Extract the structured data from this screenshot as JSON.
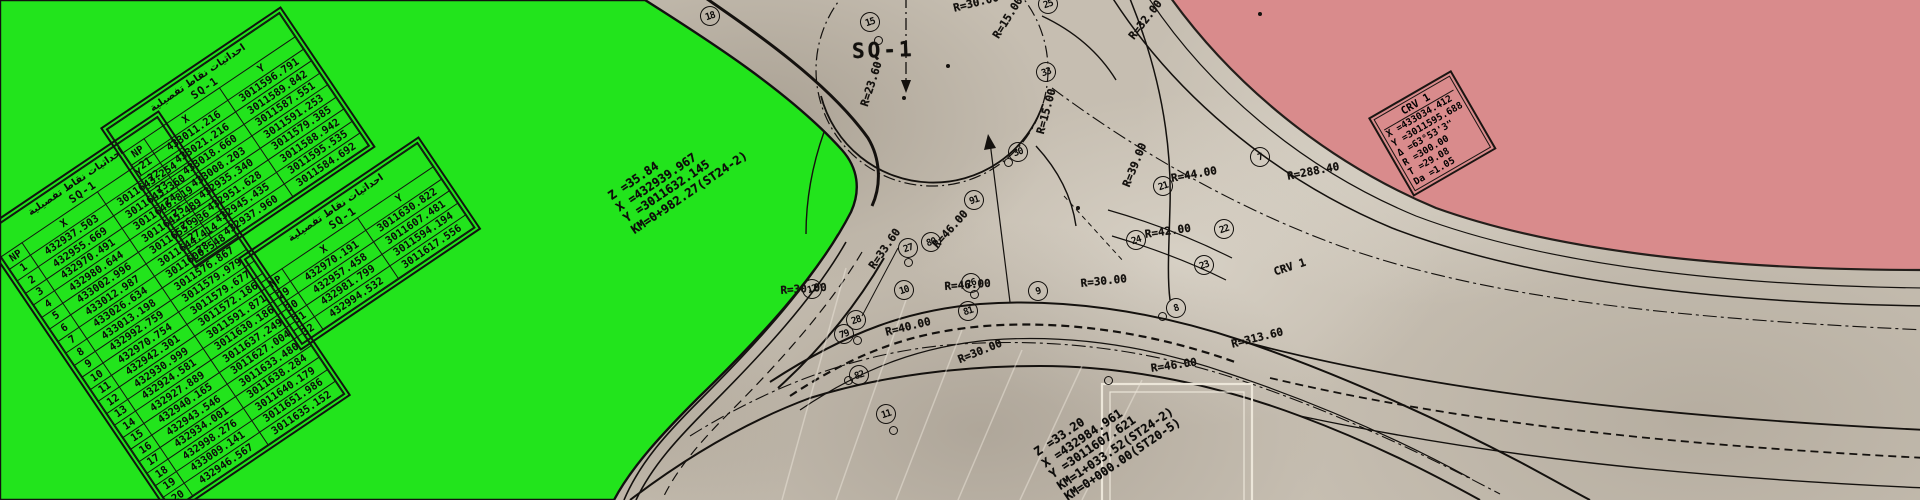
{
  "scene": {
    "square_label": "SQ-1",
    "colors": {
      "green_area": "#22e41c",
      "pink_area": "#d98b8c",
      "paper": "#c6beb1",
      "ink": "#14110e",
      "faint_line": "#f2ece0"
    },
    "table_title_ar": "احداثيات نقاط تفصيلية"
  },
  "tables": [
    {
      "id": "sq1-a",
      "title_ar": "احداثيات نقاط تفصيلية",
      "title": "SQ-1",
      "headers": [
        "NP",
        "X",
        "Y"
      ],
      "pos": {
        "x": -22,
        "y": 232,
        "rot": -34
      },
      "rows": [
        [
          "1",
          "432937.503",
          "3011643.254"
        ],
        [
          "2",
          "432955.669",
          "3011643.360"
        ],
        [
          "3",
          "432970.491",
          "3011646.819"
        ],
        [
          "4",
          "432980.644",
          "3011645.489"
        ],
        [
          "5",
          "433002.996",
          "3011655.936"
        ],
        [
          "6",
          "433012.987",
          "3011644.414"
        ],
        [
          "7",
          "433026.634",
          "3011600.548"
        ],
        [
          "8",
          "433013.198",
          "3011576.867"
        ],
        [
          "9",
          "432992.759",
          "3011579.979"
        ],
        [
          "10",
          "432970.754",
          "3011579.677"
        ],
        [
          "11",
          "432942.301",
          "3011572.186"
        ],
        [
          "12",
          "432930.999",
          "3011591.871"
        ],
        [
          "13",
          "432924.581",
          "3011630.186"
        ],
        [
          "14",
          "432927.889",
          "3011637.249"
        ],
        [
          "15",
          "432940.165",
          "3011627.004"
        ],
        [
          "16",
          "432943.546",
          "3011633.480"
        ],
        [
          "17",
          "432934.001",
          "3011638.284"
        ],
        [
          "18",
          "432998.276",
          "3011640.179"
        ],
        [
          "19",
          "433009.141",
          "3011651.986"
        ],
        [
          "20",
          "432946.567",
          "3011635.152"
        ]
      ]
    },
    {
      "id": "sq1-b",
      "title_ar": "احداثيات نقاط تفصيلية",
      "title": "SQ-1",
      "headers": [
        "NP",
        "X",
        "Y"
      ],
      "pos": {
        "x": 100,
        "y": 128,
        "rot": -34
      },
      "rows": [
        [
          "21",
          "433011.216",
          "3011596.791"
        ],
        [
          "22",
          "433021.216",
          "3011589.842"
        ],
        [
          "23",
          "433018.660",
          "3011587.551"
        ],
        [
          "24",
          "433008.203",
          "3011591.253"
        ],
        [
          "25",
          "432935.340",
          "3011579.385"
        ],
        [
          "26",
          "432951.628",
          "3011588.942"
        ],
        [
          "27",
          "432945.435",
          "3011595.535"
        ],
        [
          "28",
          "432937.960",
          "3011584.692"
        ]
      ]
    },
    {
      "id": "sq1-c",
      "title_ar": "احداثيات نقاط تفصيلية",
      "title": "SQ-1",
      "headers": [
        "NP",
        "X",
        "Y"
      ],
      "pos": {
        "x": 238,
        "y": 258,
        "rot": -34
      },
      "rows": [
        [
          "29",
          "432970.191",
          "3011630.822"
        ],
        [
          "30",
          "432957.458",
          "3011607.481"
        ],
        [
          "31",
          "432981.799",
          "3011594.194"
        ],
        [
          "32",
          "432994.532",
          "3011617.556"
        ]
      ]
    }
  ],
  "annotation_blocks": [
    {
      "id": "sq1-center-data",
      "x": 606,
      "y": 192,
      "rot": -34,
      "lines": [
        "Z =35.84",
        "X =432939.967",
        "Y =3011632.145",
        "KM=0+982.27(ST24-2)"
      ]
    },
    {
      "id": "st20-junction-data",
      "x": 1032,
      "y": 448,
      "rot": -34,
      "lines": [
        "Z =33.20",
        "X =432984.961",
        "Y =3011607.621",
        "KM=1+033.52(ST24-2)",
        "KM=0+000.00(ST20-5)"
      ]
    }
  ],
  "crv_box": {
    "title": "CRV 1",
    "x": 1368,
    "y": 118,
    "rot": -30,
    "lines": [
      "X =433034.412",
      "Y =3011595.688",
      "Δ =63°53'3\"",
      "R =300.00",
      "T =29.08",
      "Da =1.05"
    ]
  },
  "radius_labels": [
    {
      "text": "R=30.00",
      "x": 952,
      "y": 2,
      "rot": -14
    },
    {
      "text": "R=15.00",
      "x": 990,
      "y": 34,
      "rot": -58
    },
    {
      "text": "R=15.00",
      "x": 1034,
      "y": 132,
      "rot": -75
    },
    {
      "text": "R=32.00",
      "x": 1126,
      "y": 34,
      "rot": -52
    },
    {
      "text": "R=23.60",
      "x": 858,
      "y": 104,
      "rot": -72
    },
    {
      "text": "R=33.60",
      "x": 866,
      "y": 264,
      "rot": -55
    },
    {
      "text": "R=46.00",
      "x": 930,
      "y": 242,
      "rot": -48
    },
    {
      "text": "R=40.00",
      "x": 884,
      "y": 326,
      "rot": -14
    },
    {
      "text": "R=30.00",
      "x": 780,
      "y": 284,
      "rot": -4
    },
    {
      "text": "R=46.00",
      "x": 944,
      "y": 280,
      "rot": -4
    },
    {
      "text": "R=30.00",
      "x": 1080,
      "y": 277,
      "rot": -6
    },
    {
      "text": "R=39.00",
      "x": 1120,
      "y": 184,
      "rot": -68
    },
    {
      "text": "R=44.00",
      "x": 1170,
      "y": 172,
      "rot": -10
    },
    {
      "text": "R=42.00",
      "x": 1144,
      "y": 228,
      "rot": -8
    },
    {
      "text": "R=288.40",
      "x": 1286,
      "y": 170,
      "rot": -11
    },
    {
      "text": "CRV 1",
      "x": 1272,
      "y": 266,
      "rot": -18
    },
    {
      "text": "R=313.60",
      "x": 1230,
      "y": 338,
      "rot": -14
    },
    {
      "text": "R=30.00",
      "x": 956,
      "y": 354,
      "rot": -22
    },
    {
      "text": "R=46.00",
      "x": 1150,
      "y": 362,
      "rot": -8
    }
  ],
  "survey_points": [
    {
      "n": "18",
      "x": 700,
      "y": 6
    },
    {
      "n": "15",
      "x": 860,
      "y": 12
    },
    {
      "n": "25",
      "x": 1038,
      "y": -6
    },
    {
      "n": "33",
      "x": 1036,
      "y": 62
    },
    {
      "n": "30",
      "x": 1008,
      "y": 142
    },
    {
      "n": "91",
      "x": 964,
      "y": 190
    },
    {
      "n": "80",
      "x": 921,
      "y": 232
    },
    {
      "n": "27",
      "x": 898,
      "y": 238
    },
    {
      "n": "26",
      "x": 961,
      "y": 273
    },
    {
      "n": "81",
      "x": 958,
      "y": 301
    },
    {
      "n": "28",
      "x": 846,
      "y": 310
    },
    {
      "n": "79",
      "x": 834,
      "y": 324
    },
    {
      "n": "82",
      "x": 849,
      "y": 365
    },
    {
      "n": "12",
      "x": 802,
      "y": 279
    },
    {
      "n": "10",
      "x": 894,
      "y": 280
    },
    {
      "n": "9",
      "x": 1028,
      "y": 281
    },
    {
      "n": "8",
      "x": 1166,
      "y": 298
    },
    {
      "n": "7",
      "x": 1250,
      "y": 147
    },
    {
      "n": "11",
      "x": 876,
      "y": 404
    },
    {
      "n": "21",
      "x": 1153,
      "y": 176
    },
    {
      "n": "22",
      "x": 1214,
      "y": 219
    },
    {
      "n": "23",
      "x": 1194,
      "y": 255
    },
    {
      "n": "24",
      "x": 1126,
      "y": 230
    }
  ],
  "markers": [
    {
      "x": 874,
      "y": 36
    },
    {
      "x": 1004,
      "y": 158
    },
    {
      "x": 889,
      "y": 426
    },
    {
      "x": 1158,
      "y": 312
    },
    {
      "x": 844,
      "y": 376
    },
    {
      "x": 970,
      "y": 290
    },
    {
      "x": 904,
      "y": 258
    },
    {
      "x": 853,
      "y": 336
    },
    {
      "x": 1104,
      "y": 376
    }
  ],
  "dots": [
    {
      "x": 946,
      "y": 64
    },
    {
      "x": 1076,
      "y": 206
    },
    {
      "x": 1258,
      "y": 12
    },
    {
      "x": 902,
      "y": 96
    }
  ]
}
